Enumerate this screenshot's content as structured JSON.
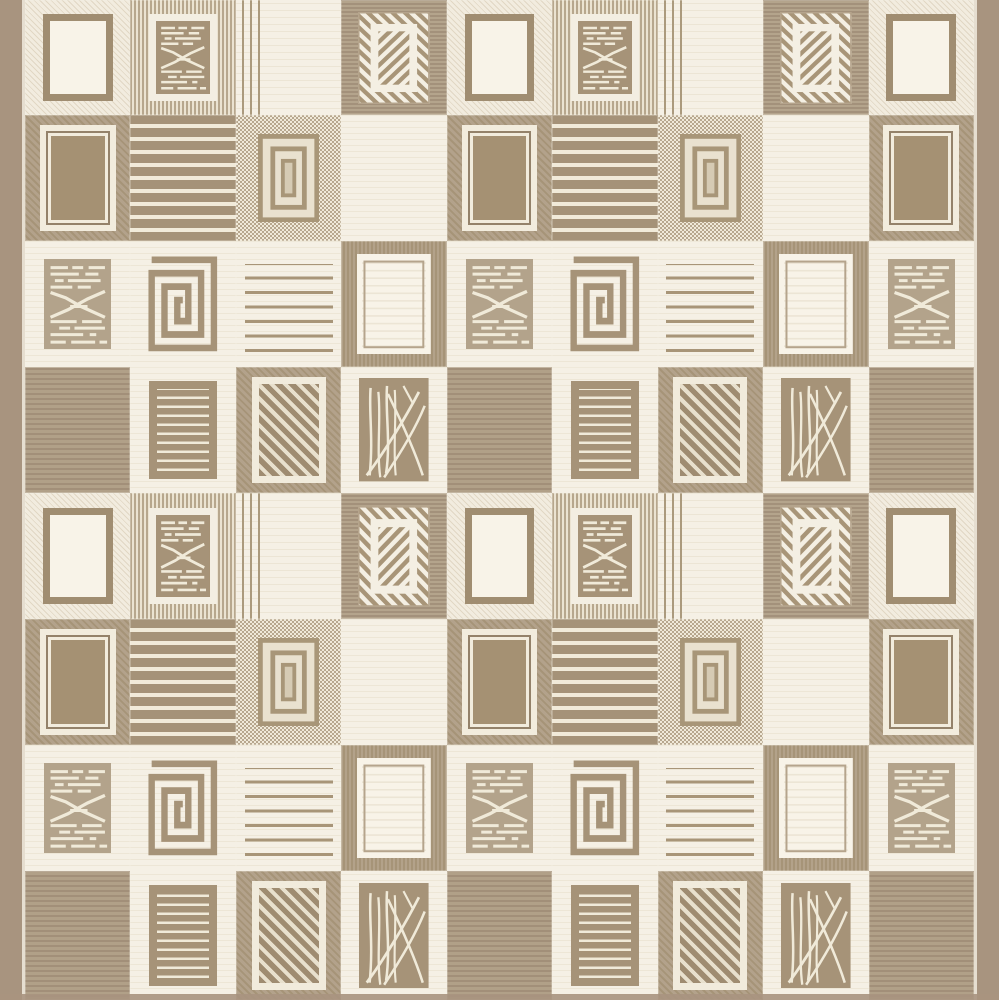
{
  "artwork": {
    "kind": "flat-weave patchwork rug photograph",
    "palette_style": "beige / taupe / cream"
  },
  "palette": {
    "cream": "#f4efe3",
    "cream_bright": "#f8f3e8",
    "cream_line": "#f0ead9",
    "cream_faint": "#ece5d5",
    "taupe": "#a69378",
    "taupe_light": "#b3a38b",
    "taupe_dark": "#a08d71",
    "ring_fill": "#e9e1cf",
    "ring_core": "#d6cbb4",
    "border_strip": "#a8947f"
  },
  "layout": {
    "canvas": {
      "width": 999,
      "height": 1000
    },
    "left_border_px": 25,
    "right_border_px": 25,
    "bottom_border_px": 6,
    "columns": 9,
    "row_heights_px": [
      115,
      126,
      126,
      126,
      126,
      126,
      126,
      129
    ],
    "row_pattern": [
      "A",
      "B",
      "C",
      "D",
      "A",
      "B",
      "C",
      "D"
    ],
    "column_pattern": [
      0,
      1,
      2,
      3,
      0,
      1,
      2,
      3,
      0
    ]
  },
  "cell_types": {
    "A0": {
      "label": "cream diagonal-weave field with empty taupe frame",
      "background": "bg-cream-diag",
      "motif": "frame"
    },
    "A1": {
      "label": "vertical pinstripe field, taupe rect with broken text-lines and X",
      "background": "bg-pinstripe",
      "motif": "textx-framed"
    },
    "A2": {
      "label": "plain cream field with pinstripe cluster at left",
      "background": "bg-cream-leftpins",
      "motif": "none"
    },
    "A3": {
      "label": "ribbed taupe field, cream rect with herringbone diagonal bands",
      "background": "bg-taupe-h",
      "motif": "herringbone"
    },
    "B0": {
      "label": "diagonal taupe field, solid rect with double cream frame",
      "background": "bg-taupe-diag",
      "motif": "framed-solid"
    },
    "B1": {
      "label": "bold cream horizontal stripes on taupe",
      "background": "bg-bold-stripes",
      "motif": "none"
    },
    "B2": {
      "label": "dotted field with three concentric rectangle outlines",
      "background": "bg-dots",
      "motif": "concentric"
    },
    "B3": {
      "label": "plain cream field with faint weft lines",
      "background": "bg-cream",
      "motif": "none"
    },
    "C0": {
      "label": "cream field, light-taupe rect with broken text-lines and X",
      "background": "bg-cream",
      "motif": "textx-plain"
    },
    "C1": {
      "label": "cream field with greek-key rectangular spiral",
      "background": "bg-cream",
      "motif": "spiral"
    },
    "C2": {
      "label": "cream field with rows of wavy taupe dashes",
      "background": "bg-cream-dashrows",
      "motif": "none"
    },
    "C3": {
      "label": "vertical-rib taupe field with plain cream inset rect",
      "background": "bg-taupe-v",
      "motif": "plain-rect"
    },
    "D0": {
      "label": "solid taupe field with fine horizontal ribs",
      "background": "bg-taupe-ribs",
      "motif": "none"
    },
    "D1": {
      "label": "cream field, taupe rect with fine cream stripes",
      "background": "bg-cream",
      "motif": "lined-rect"
    },
    "D2": {
      "label": "diagonal taupe field, cream-framed rect with diagonal stripes",
      "background": "bg-taupe-diag",
      "motif": "diag-rect"
    },
    "D3": {
      "label": "cream field, taupe rect with scratched scribble lines",
      "background": "bg-cream",
      "motif": "scribble"
    }
  }
}
